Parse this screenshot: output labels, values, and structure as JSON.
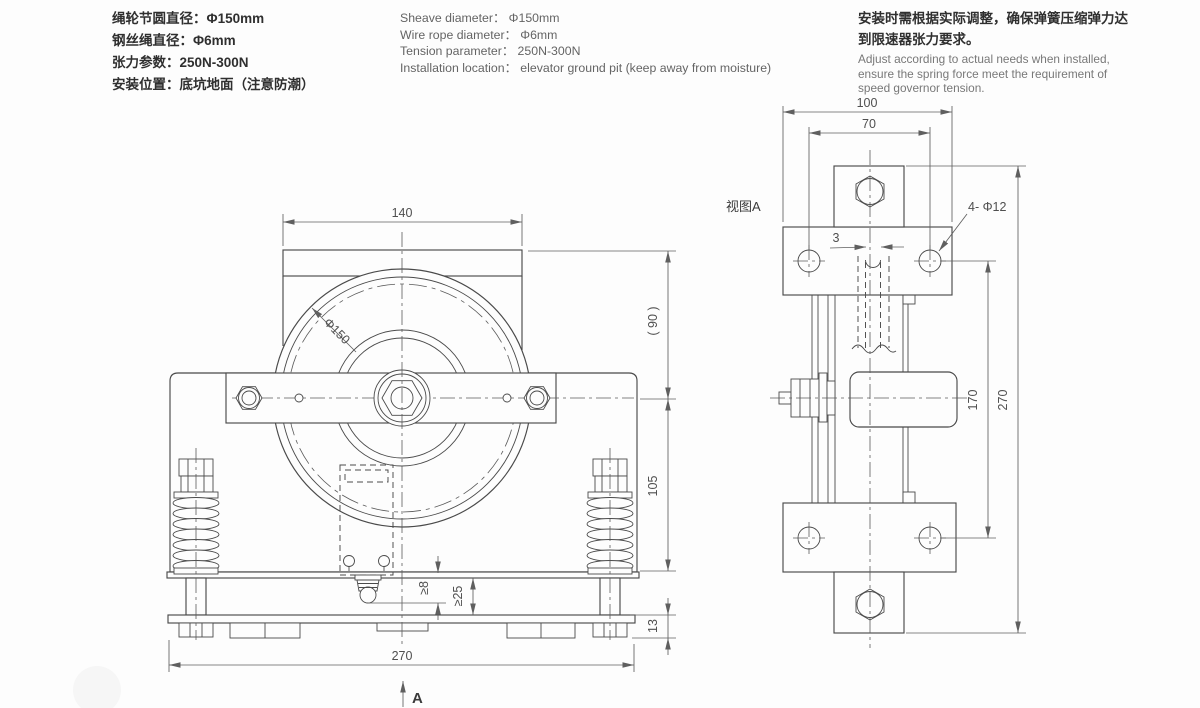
{
  "specs_cn": {
    "l1": "绳轮节圆直径：Φ150mm",
    "l2": "钢丝绳直径：Φ6mm",
    "l3": "张力参数：250N-300N",
    "l4": "安装位置：底坑地面（注意防潮）"
  },
  "specs_en": {
    "l1": "Sheave diameter： Φ150mm",
    "l2": "Wire rope diameter： Φ6mm",
    "l3": "Tension parameter： 250N-300N",
    "l4": "Installation location： elevator ground pit (keep away from moisture)"
  },
  "install_note": {
    "cn_l1": "安装时需根据实际调整，确保弹簧压缩弹力达",
    "cn_l2": "到限速器张力要求。",
    "en_l1": "Adjust according to actual needs when installed,",
    "en_l2": "ensure the spring force meet the requirement of",
    "en_l3": "speed governor tension."
  },
  "front": {
    "dim_top_width": "140",
    "sheave_label": "Φ150",
    "dim_bracket_height": "( 90 )",
    "dim_arm_to_base": "105",
    "dim_gap8": "≥8",
    "dim_gap25": "≥25",
    "dim_base_thk": "13",
    "dim_total_width": "270",
    "section_arrow": "A"
  },
  "side": {
    "view_label": "视图A",
    "dim_top_width": "100",
    "dim_hole_span": "70",
    "dim_slot_gap": "3",
    "holes_label": "4- Φ12",
    "dim_hole_height": "170",
    "dim_total_height": "270"
  },
  "colors": {
    "background": "#fdfdfd",
    "line": "#4a4a4a",
    "dim_text": "#4f4f4f"
  }
}
